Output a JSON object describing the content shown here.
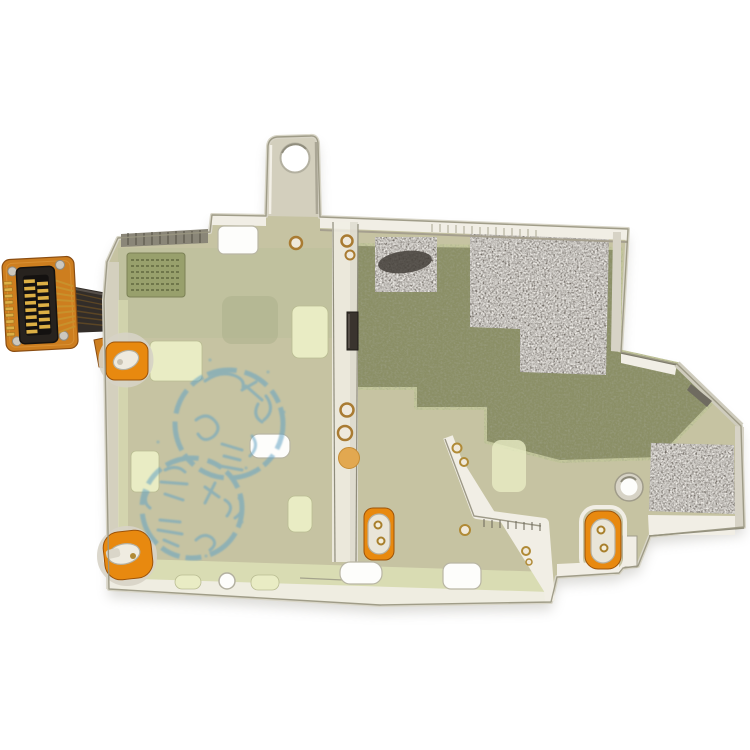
{
  "meta": {
    "alt": "Product photo on a white background: a SIM card reader contact flex cable module with a large khaki-green metal shield plate, orange flex connector on the left, dark gray adhesive pads, orange rivet contact pads and faint blue circular ink stamps"
  },
  "scene": {
    "background_color": "#ffffff",
    "objects": [
      {
        "name": "metal-shield-plate",
        "description": "Large khaki-green metal shield plate with stepped edges, cutouts and slots"
      },
      {
        "name": "mounting-tab",
        "description": "Vertical metal tab with a round hole, top center"
      },
      {
        "name": "flex-cable-connector",
        "description": "Orange flex pad with black board-to-board connector and gold contact fingers, left side"
      },
      {
        "name": "ribbon-cable",
        "description": "Dark flat ribbon joining the connector to the plate edge"
      },
      {
        "name": "thermal-pad-small",
        "description": "Small dark gray granular adhesive pad, upper middle"
      },
      {
        "name": "thermal-pad-upper",
        "description": "Large dark gray granular adhesive pad, upper right"
      },
      {
        "name": "thermal-pad-lower-right",
        "description": "Dark gray granular adhesive pad on the lower right wing"
      },
      {
        "name": "olive-tape-region",
        "description": "Stepped olive-green tape area covering the middle right of the plate"
      },
      {
        "name": "mesh-antenna-patch",
        "description": "Dotted sage-green mesh patch near the upper left corner"
      },
      {
        "name": "ink-stamp",
        "description": "Two faint blue circular QC ink stamps with illegible characters, center left"
      },
      {
        "name": "contact-rivet-pads",
        "description": "Four orange pads with bright metal rivet contacts at plate edges"
      },
      {
        "name": "screw-holes",
        "description": "Round screw holes, slots and rectangular cutouts"
      },
      {
        "name": "solder-rivets",
        "description": "Small gold rivet heads along the center rail and ridge"
      }
    ]
  },
  "palette": {
    "bg": "#ffffff",
    "plate": "#c6c3a2",
    "plate_sage": "#bcbf9b",
    "plate_pale": "#e9ecc4",
    "plate_margin": "#dce0b6",
    "olive": "#8b8f66",
    "olive_halo": "#c4c79c",
    "pad_gray": "#6e6861",
    "pad_smudge": "#433e38",
    "metal_bright": "#f1eee5",
    "metal_mid": "#d7d3c6",
    "metal_dark": "#9b9786",
    "metal_edge": "#8f8c7c",
    "flex_orange": "#cd7e1f",
    "pad_orange": "#e8890f",
    "dot_orange": "#e2a850",
    "gold": "#dcaf45",
    "gold_dark": "#9a7322",
    "connector_black": "#27221e",
    "ribbon_dark": "#322d29",
    "stamp_blue": "#64a3c4",
    "mesh_green": "#98a06c",
    "mesh_line": "#666c44"
  }
}
